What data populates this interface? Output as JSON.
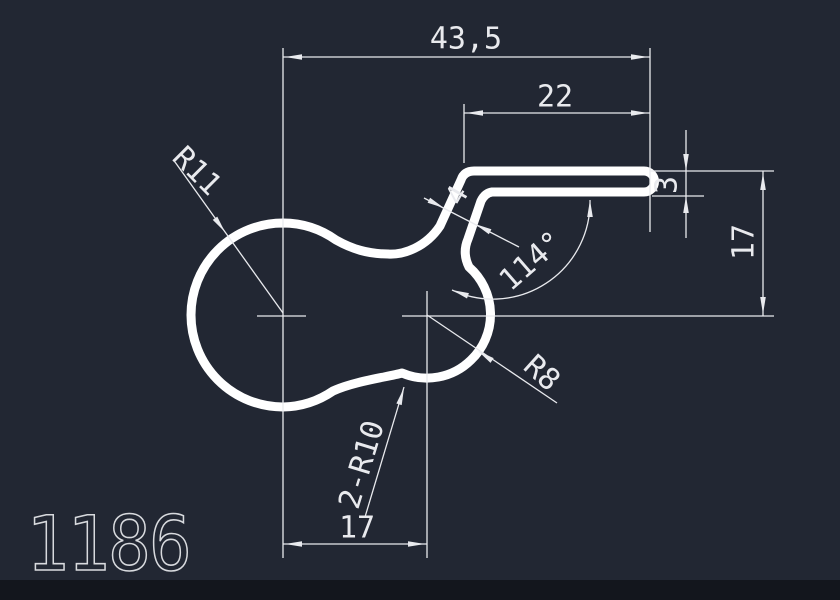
{
  "drawing": {
    "part_number": "1186",
    "labels": {
      "total_width": "43,5",
      "upper_width": "22",
      "left_radius": "R11",
      "arm_thickness": "4",
      "bend_angle": "114°",
      "bar_thickness": "3",
      "right_height": "17",
      "right_radius": "R8",
      "waist_radius": "2-R10",
      "bottom_width": "17"
    },
    "colors": {
      "background": "#222733",
      "bottom_strip": "#13161d",
      "outline": "#ffffff",
      "dimension_lines": "#e9eaee",
      "dimension_text": "#e9eaee",
      "part_number_color": "#d8dade"
    }
  }
}
